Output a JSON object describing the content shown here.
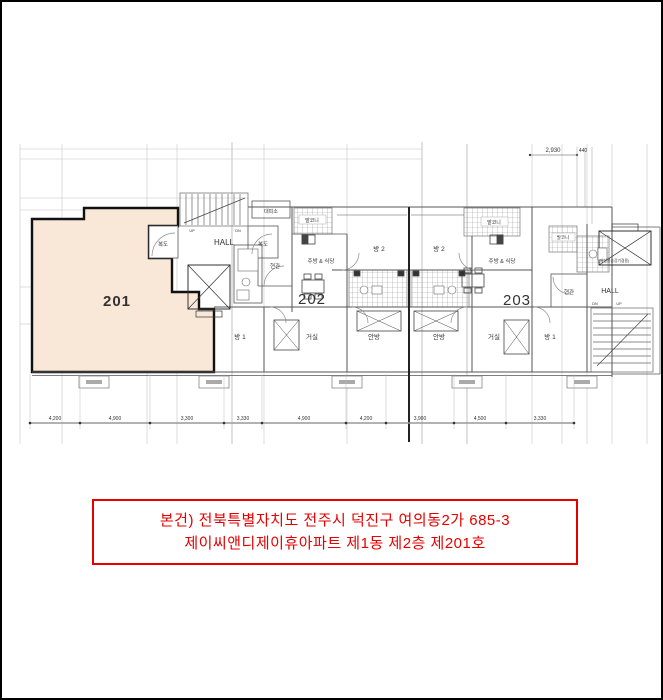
{
  "plan": {
    "colors": {
      "unit_fill": "#f9e8d8",
      "unit_highlight_text": "#ff0000",
      "wall": "#555555",
      "caption_red": "#e60000"
    },
    "units": [
      {
        "number": "201"
      },
      {
        "number": "202"
      },
      {
        "number": "203"
      }
    ],
    "labels": {
      "corridor_left": "복도",
      "corridor_right": "복도",
      "hall_center": "HALL",
      "shelter": "대피소",
      "up": "UP",
      "dn": "DN",
      "balcony_202": "발코니",
      "kitchen_202": "주방 & 식당",
      "room2_202": "방 2",
      "entrance_202": "현관",
      "room2_203": "방 2",
      "balcony_203": "발코니",
      "kitchen_203": "주방 & 식당",
      "balcony_small_203": "발코니",
      "entrance_203": "현관",
      "hall_right": "HALL",
      "elevator_note": "(비상용승강기겸용)",
      "dn_right": "DN",
      "up_right": "UP",
      "room1_202": "방 1",
      "living_202": "거실",
      "master_202": "안방",
      "master_203": "안방",
      "living_203": "거실",
      "room1_203": "방 1"
    },
    "dimensions": {
      "bottom": [
        "4,200",
        "4,900",
        "3,300",
        "3,330",
        "4,900",
        "4,200",
        "3,900",
        "4,500",
        "3,330"
      ],
      "top_right_a": "2,930",
      "top_right_b": "440"
    }
  },
  "caption": {
    "line1": "본건) 전북특별자치도 전주시 덕진구 여의동2가 685-3",
    "line2": "제이씨앤디제이휴아파트 제1동 제2층 제201호"
  }
}
